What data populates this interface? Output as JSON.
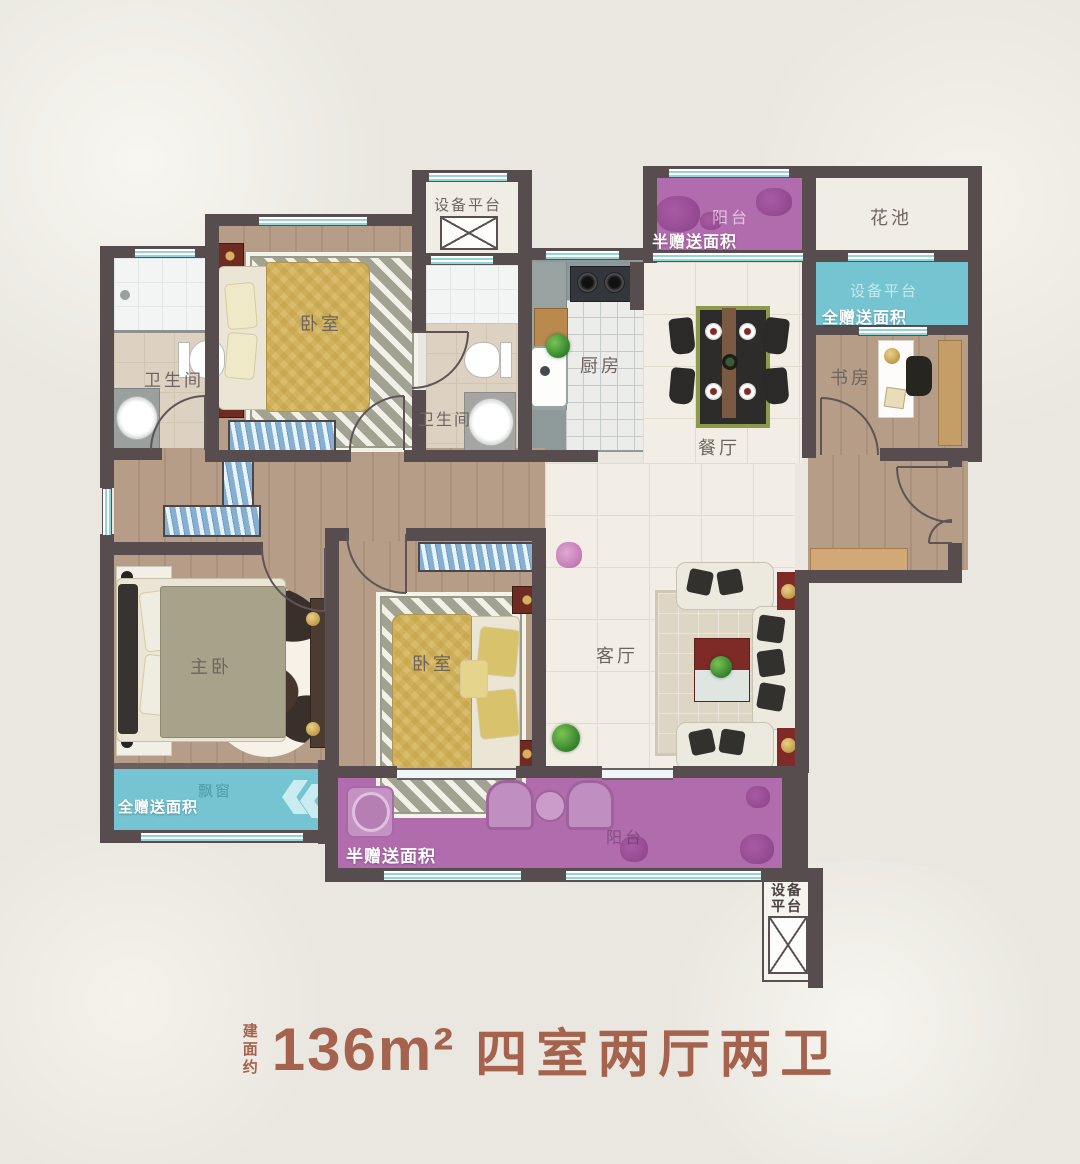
{
  "title": {
    "prefix": "建面约",
    "area": "136m²",
    "layout_spec": "四室两厅两卫"
  },
  "rooms": {
    "equip_top": {
      "label": "设备平台"
    },
    "bedroom_top": {
      "label": "卧室"
    },
    "bath_left": {
      "label": "卫生间"
    },
    "bath_mid": {
      "label": "卫生间"
    },
    "kitchen": {
      "label": "厨房"
    },
    "balcony_top": {
      "label": "阳台",
      "badge": "半赠送面积"
    },
    "flower_bed": {
      "label": "花池"
    },
    "equip_right": {
      "label": "设备平台",
      "badge": "全赠送面积"
    },
    "study": {
      "label": "书房"
    },
    "dining": {
      "label": "餐厅"
    },
    "master_bedroom": {
      "label": "主卧"
    },
    "bay_window": {
      "label": "飘窗",
      "badge": "全赠送面积"
    },
    "bedroom_bottom": {
      "label": "卧室"
    },
    "living": {
      "label": "客厅"
    },
    "balcony_bottom": {
      "label": "阳台",
      "badge": "半赠送面积"
    },
    "equip_bottom": {
      "label": "设备平台",
      "line1": "设备",
      "line2": "平台"
    }
  },
  "colors": {
    "wall": "#574d4e",
    "balcony_purple": "#b16cad",
    "gift_cyan": "#74c4d2",
    "wood_floor": "#b59d87",
    "tile_floor": "#f2eee5",
    "kitchen_floor": "#8d9a99",
    "window_teal": "#93d4d8",
    "title_text": "#a5624d",
    "accent_red": "#7e2a26"
  }
}
